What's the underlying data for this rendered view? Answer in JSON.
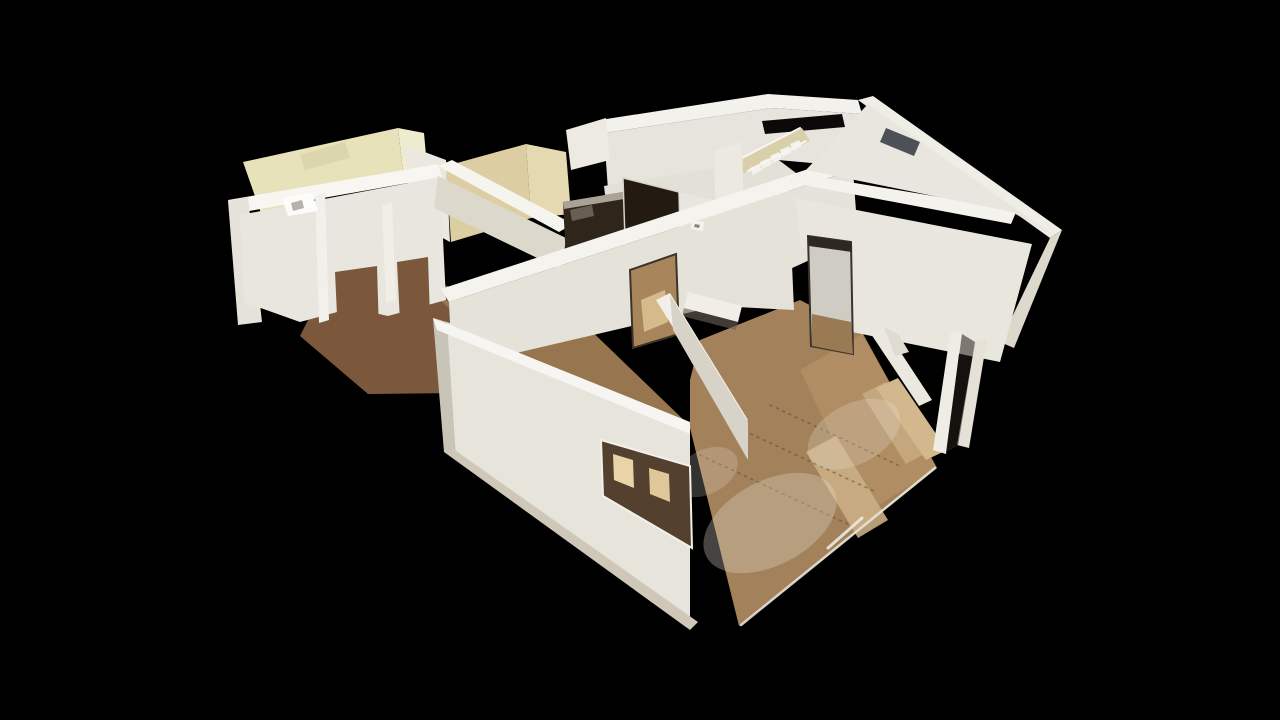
{
  "meta": {
    "view_type": "dollhouse-3d",
    "description": "Overhead oblique 3D dollhouse view of a scanned single-floor home interior rendered on a black background; cut white walls, cream-yellow kitchen nook walls, dark front door and refrigerator panels, a staircase, window cutouts, and warm wood floors with white scan-haze circles and sunlit streaks."
  },
  "canvas": {
    "width": 1280,
    "height": 720,
    "background": "#000000"
  },
  "palette": {
    "background": "#000000",
    "wall_white": "#e7e4dc",
    "wall_top_highlight": "#f6f5f1",
    "wall_shadow": "#c9c4b8",
    "wall_cream_yellow": "#e7e2ba",
    "wall_tan_kitchen": "#dccda3",
    "floor_wood": "#a3815a",
    "floor_wood_dark": "#7b573c",
    "floor_sunlit": "#d9c39a",
    "door_dark": "#231a12",
    "haze_white": "#e9e2d6"
  },
  "scene": {
    "elements": [
      {
        "kind": "polygon",
        "n": "floor-left-room",
        "f": "#7b573c",
        "p": "300,336 332,272 448,286 560,392 368,394"
      },
      {
        "kind": "polygon",
        "n": "floor-corridor",
        "f": "#97764f",
        "p": "440,300 580,320 690,426 548,400"
      },
      {
        "kind": "polygon",
        "n": "floor-corridor-streak-1",
        "f": "#d9c39a",
        "o": 0.85,
        "p": "468,382 520,368 633,450 585,466"
      },
      {
        "kind": "polygon",
        "n": "floor-corridor-streak-2",
        "f": "#c7ad84",
        "o": 0.8,
        "p": "452,352 478,344 528,382 502,392"
      },
      {
        "kind": "polygon",
        "n": "floor-main",
        "f": "#a3815a",
        "p": "690,428 690,380 700,340 800,300 862,332 937,468 739,626"
      },
      {
        "kind": "polygon",
        "n": "floor-main-light",
        "f": "#b08d63",
        "p": "800,370 862,334 937,468 868,512"
      },
      {
        "kind": "polygon",
        "n": "floor-main-streak-1",
        "f": "#cbae84",
        "o": 0.9,
        "p": "806,452 836,436 888,520 858,538"
      },
      {
        "kind": "polygon",
        "n": "floor-main-streak-2",
        "f": "#c9ac82",
        "o": 0.85,
        "p": "862,394 886,382 928,452 906,464"
      },
      {
        "kind": "polygon",
        "n": "floor-right-sun-strip",
        "f": "#d3b88d",
        "p": "876,388 898,378 947,450 926,460"
      },
      {
        "kind": "polygon",
        "n": "floor-hall-patch-1",
        "f": "#c3a173",
        "o": 0.9,
        "p": "640,262 670,272 676,305 646,296"
      },
      {
        "kind": "polygon",
        "n": "floor-hall-patch-2",
        "f": "#b1946b",
        "o": 0.85,
        "p": "694,228 722,236 716,256 690,248"
      },
      {
        "kind": "line",
        "n": "plank-seam-1",
        "x1": 700,
        "y1": 455,
        "x2": 850,
        "y2": 525,
        "s": "#5f4730",
        "w": 1.5,
        "d": "2,5",
        "o": 0.55
      },
      {
        "kind": "line",
        "n": "plank-seam-2",
        "x1": 738,
        "y1": 428,
        "x2": 876,
        "y2": 492,
        "s": "#5f4730",
        "w": 1.5,
        "d": "2,5",
        "o": 0.55
      },
      {
        "kind": "line",
        "n": "plank-seam-3",
        "x1": 770,
        "y1": 405,
        "x2": 898,
        "y2": 465,
        "s": "#5f4730",
        "w": 1.5,
        "d": "2,5",
        "o": 0.55
      },
      {
        "kind": "ellipse",
        "n": "floor-haze-1",
        "cx": 770,
        "cy": 523,
        "rx": 72,
        "ry": 42,
        "rot": -28,
        "f": "#e9e2d6",
        "o": 0.3
      },
      {
        "kind": "ellipse",
        "n": "floor-haze-2",
        "cx": 854,
        "cy": 434,
        "rx": 50,
        "ry": 30,
        "rot": -28,
        "f": "#e9e2d6",
        "o": 0.26
      },
      {
        "kind": "ellipse",
        "n": "floor-haze-3",
        "cx": 706,
        "cy": 472,
        "rx": 34,
        "ry": 22,
        "rot": -28,
        "f": "#e9e2d6",
        "o": 0.22
      },
      {
        "kind": "polygon",
        "n": "wall-back-top-band",
        "f": "#f2f1ec",
        "p": "600,120 768,94 858,100 862,114 772,108 604,133"
      },
      {
        "kind": "polygon",
        "n": "wall-back-face",
        "f": "#e6e4dc",
        "p": "604,133 772,108 862,114 868,168 778,160 608,190"
      },
      {
        "kind": "polygon",
        "n": "wall-back-hall-face",
        "f": "#e3e0d7",
        "p": "604,186 776,158 800,176 760,230 700,225 640,240 608,220"
      },
      {
        "kind": "polygon",
        "n": "stair-gap-dark",
        "f": "#0c0a08",
        "p": "762,121 842,114 845,127 765,134"
      },
      {
        "kind": "polygon",
        "n": "stair-stringer",
        "f": "#d9cfab",
        "p": "736,160 802,128 810,141 744,173"
      },
      {
        "kind": "polygon",
        "n": "stair-step-1",
        "f": "#f3f2ec",
        "p": "750,168 759,164 762,170 753,175"
      },
      {
        "kind": "polygon",
        "n": "stair-step-2",
        "f": "#f3f2ec",
        "p": "760,162 769,158 772,164 763,169"
      },
      {
        "kind": "polygon",
        "n": "stair-step-3",
        "f": "#f3f2ec",
        "p": "770,156 779,152 782,158 773,163"
      },
      {
        "kind": "polygon",
        "n": "stair-step-4",
        "f": "#f3f2ec",
        "p": "780,150 789,146 792,152 783,157"
      },
      {
        "kind": "polygon",
        "n": "stair-step-5",
        "f": "#f3f2ec",
        "p": "790,144 799,140 802,146 793,151"
      },
      {
        "kind": "line",
        "n": "stair-rail-1",
        "x1": 742,
        "y1": 158,
        "x2": 800,
        "y2": 128,
        "s": "#f7f6f2",
        "w": 2
      },
      {
        "kind": "line",
        "n": "stair-rail-2",
        "x1": 748,
        "y1": 171,
        "x2": 806,
        "y2": 141,
        "s": "#f7f6f2",
        "w": 2
      },
      {
        "kind": "polygon",
        "n": "stair-wall",
        "f": "#ece9e2",
        "p": "714,150 742,142 746,304 718,310"
      },
      {
        "kind": "polygon",
        "n": "wall-yellow-room-back",
        "f": "#e7e2ba",
        "p": "243,162 398,128 403,172 262,216"
      },
      {
        "kind": "polygon",
        "n": "wall-yellow-smudge",
        "f": "#d8d1a6",
        "o": 0.7,
        "p": "300,155 345,142 350,158 305,170"
      },
      {
        "kind": "polygon",
        "n": "wall-yellow-room-right",
        "f": "#efebce",
        "p": "398,128 424,133 428,178 403,172"
      },
      {
        "kind": "polygon",
        "n": "wall-yellow-kitchen-divider",
        "f": "#eae8e0",
        "p": "406,145 446,160 450,242 410,220"
      },
      {
        "kind": "polygon",
        "n": "wall-left-top-band",
        "f": "#f7f6f1",
        "p": "228,200 438,164 442,177 232,214"
      },
      {
        "kind": "polygon",
        "n": "wall-left-outer-face",
        "f": "#e5e2da",
        "p": "228,201 248,197 262,322 238,325"
      },
      {
        "kind": "polygon",
        "n": "wall-left-room-face",
        "f": "#e9e6df",
        "p": "240,215 440,177 446,300 388,316 352,308 300,322 244,302"
      },
      {
        "kind": "polygon",
        "n": "doorway-left-1",
        "f": "#7b573c",
        "p": "335,272 377,266 379,332 338,336"
      },
      {
        "kind": "polygon",
        "n": "doorway-left-2",
        "f": "#7b573c",
        "p": "397,262 428,257 430,318 400,322"
      },
      {
        "kind": "polygon",
        "n": "pillar-highlight-1",
        "f": "#f2f0ea",
        "p": "315,196 325,192 329,320 319,323"
      },
      {
        "kind": "polygon",
        "n": "pillar-highlight-2",
        "f": "#f0eee7",
        "p": "382,206 392,202 396,300 386,303"
      },
      {
        "kind": "polygon",
        "n": "stove-fixture",
        "f": "#fcfcfa",
        "p": "282,198 312,193 318,211 288,216"
      },
      {
        "kind": "polygon",
        "n": "stove-fixture-detail",
        "f": "#b7b2a9",
        "p": "291,203 302,200 304,208 293,211"
      },
      {
        "kind": "polygon",
        "n": "wall-kitchen-tan-left",
        "f": "#dccda3",
        "p": "446,166 526,144 531,218 451,242"
      },
      {
        "kind": "polygon",
        "n": "wall-kitchen-tan-right",
        "f": "#e5d9b1",
        "p": "526,144 566,152 571,214 531,218"
      },
      {
        "kind": "polygon",
        "n": "wall-kitchen-top-white",
        "f": "#eceae1",
        "p": "566,130 606,118 610,160 571,170"
      },
      {
        "kind": "polygon",
        "n": "wall-kitchen-front-band",
        "f": "#f5f4ef",
        "p": "438,166 452,160 573,224 559,232"
      },
      {
        "kind": "polygon",
        "n": "wall-kitchen-front-face",
        "f": "#ddd8cc",
        "p": "438,176 566,238 562,270 434,208"
      },
      {
        "kind": "polygon",
        "n": "appliance-fridge",
        "f": "#30251b",
        "p": "563,202 623,192 626,254 566,260"
      },
      {
        "kind": "polygon",
        "n": "fridge-specular",
        "f": "#887d70",
        "o": 0.65,
        "p": "570,210 592,205 594,216 572,221"
      },
      {
        "kind": "polygon",
        "n": "fridge-top-edge",
        "f": "#c9c2b6",
        "o": 0.8,
        "p": "563,202 623,192 624,199 564,209"
      },
      {
        "kind": "polygon",
        "n": "front-door-dark",
        "f": "#231a12",
        "st": "#d8d3c8",
        "sw": 1.5,
        "p": "623,178 679,192 681,274 626,270"
      },
      {
        "kind": "polygon",
        "n": "wall-right-of-door",
        "f": "#e9e6df",
        "p": "679,192 714,200 717,300 683,276"
      },
      {
        "kind": "polygon",
        "n": "wall-corridor-right",
        "f": "#e4e1d8",
        "p": "714,200 790,218 794,310 718,306"
      },
      {
        "kind": "polygon",
        "n": "wall-long-band",
        "f": "#f4f3ee",
        "p": "441,289 845,157 853,170 449,302"
      },
      {
        "kind": "polygon",
        "n": "wall-long-face",
        "f": "#e5e2d9",
        "p": "449,302 853,170 858,238 700,310 452,368"
      },
      {
        "kind": "polygon",
        "n": "doorway-long-wall",
        "f": "#a8855a",
        "st": "#3c342b",
        "sw": 2,
        "p": "630,270 676,254 679,334 633,348"
      },
      {
        "kind": "polygon",
        "n": "doorway-long-wall-light",
        "f": "#d6ba8c",
        "p": "641,300 665,290 668,322 644,332"
      },
      {
        "kind": "polygon",
        "n": "counter-island-top",
        "f": "#f0eee7",
        "p": "688,292 742,306 738,322 684,308"
      },
      {
        "kind": "polygon",
        "n": "counter-island-shadow",
        "f": "#6b6257",
        "o": 0.6,
        "p": "684,308 738,322 736,330 682,316"
      },
      {
        "kind": "polygon",
        "n": "wall-hall-band",
        "f": "#f1efe8",
        "p": "656,300 670,293 748,420 735,428"
      },
      {
        "kind": "polygon",
        "n": "wall-hall-face",
        "f": "#d7d3c8",
        "p": "670,295 748,422 748,460 673,330"
      },
      {
        "kind": "polygon",
        "n": "wall-right-back-band",
        "f": "#f3f2ec",
        "p": "788,182 801,174 1017,210 1011,224"
      },
      {
        "kind": "polygon",
        "n": "wall-topright-outer-band",
        "f": "#eeede6",
        "p": "858,100 873,96 1062,230 1050,238"
      },
      {
        "kind": "polygon",
        "n": "wall-topright-inner-face",
        "f": "#e8e6de",
        "p": "806,170 868,104 1054,236 1012,212"
      },
      {
        "kind": "polygon",
        "n": "window-sliver-dark",
        "f": "#232c33",
        "o": 0.8,
        "p": "886,128 920,142 914,156 880,142"
      },
      {
        "kind": "polygon",
        "n": "wall-right-outer-face",
        "f": "#dcd8cc",
        "p": "1050,238 1062,230 1014,348 1000,342"
      },
      {
        "kind": "polygon",
        "n": "wall-right-room-face",
        "f": "#e9e6de",
        "p": "795,198 1032,244 1000,362 852,332 850,252 801,248"
      },
      {
        "kind": "polygon",
        "n": "doorway-right-room",
        "f": "#cfccc3",
        "st": "#3a332c",
        "sw": 2,
        "p": "808,236 851,242 853,354 811,346"
      },
      {
        "kind": "polygon",
        "n": "doorway-right-room-floor",
        "f": "#9a7a52",
        "p": "812,314 851,322 853,354 812,346"
      },
      {
        "kind": "polygon",
        "n": "doorway-right-header",
        "f": "#2e2822",
        "p": "808,236 851,242 852,252 809,246"
      },
      {
        "kind": "polygon",
        "n": "window-frame-right-1",
        "f": "#efece5",
        "p": "950,334 962,331 946,454 933,450"
      },
      {
        "kind": "polygon",
        "n": "window-frame-right-2",
        "f": "#e5e1d6",
        "p": "975,342 987,339 969,448 957,445"
      },
      {
        "kind": "polygon",
        "n": "window-gap-dark",
        "f": "#241f19",
        "o": 0.55,
        "p": "962,334 975,342 958,446 946,452"
      },
      {
        "kind": "polygon",
        "n": "wall-partition-main-floor",
        "f": "#ebe8e0",
        "p": "871,334 884,327 932,400 919,406"
      },
      {
        "kind": "polygon",
        "n": "wall-partition-return",
        "f": "#dfdbd1",
        "p": "884,327 899,335 909,352 895,356"
      },
      {
        "kind": "polygon",
        "n": "thermostat",
        "f": "#f4f2ec",
        "p": "692,220 704,222 703,231 691,229"
      },
      {
        "kind": "polygon",
        "n": "thermostat-detail",
        "f": "#8a857c",
        "p": "695,224 700,225 699,228 694,227"
      },
      {
        "kind": "polygon",
        "n": "wall-front-side-face",
        "f": "#c9c4b8",
        "p": "433,318 447,322 458,456 444,452"
      },
      {
        "kind": "polygon",
        "n": "wall-front-main-face",
        "f": "#e7e4dc",
        "p": "447,322 690,426 690,627 456,458"
      },
      {
        "kind": "polygon",
        "n": "wall-front-top-band",
        "f": "#f6f5f1",
        "p": "433,318 690,422 690,434 437,330"
      },
      {
        "kind": "polygon",
        "n": "window-front-opening",
        "f": "#54402f",
        "st": "#f2f0ea",
        "sw": 2,
        "p": "601,440 690,466 692,548 603,496"
      },
      {
        "kind": "polygon",
        "n": "window-front-lit-1",
        "f": "#e9d4a8",
        "p": "613,454 633,460 634,488 614,480"
      },
      {
        "kind": "polygon",
        "n": "window-front-lit-2",
        "f": "#e0c79a",
        "p": "649,468 669,474 670,502 650,494"
      },
      {
        "kind": "polygon",
        "n": "wall-front-bottom-bevel",
        "f": "#cfc8b8",
        "p": "444,452 452,448 698,622 690,630"
      },
      {
        "kind": "line",
        "n": "floor-edge-trim",
        "x1": 935,
        "y1": 468,
        "x2": 741,
        "y2": 625,
        "s": "#e8e4da",
        "w": 2.5,
        "o": 0.9
      },
      {
        "kind": "line",
        "n": "baseboard-right",
        "x1": 862,
        "y1": 518,
        "x2": 828,
        "y2": 548,
        "s": "#eceae0",
        "w": 3,
        "o": 0.9
      }
    ]
  }
}
